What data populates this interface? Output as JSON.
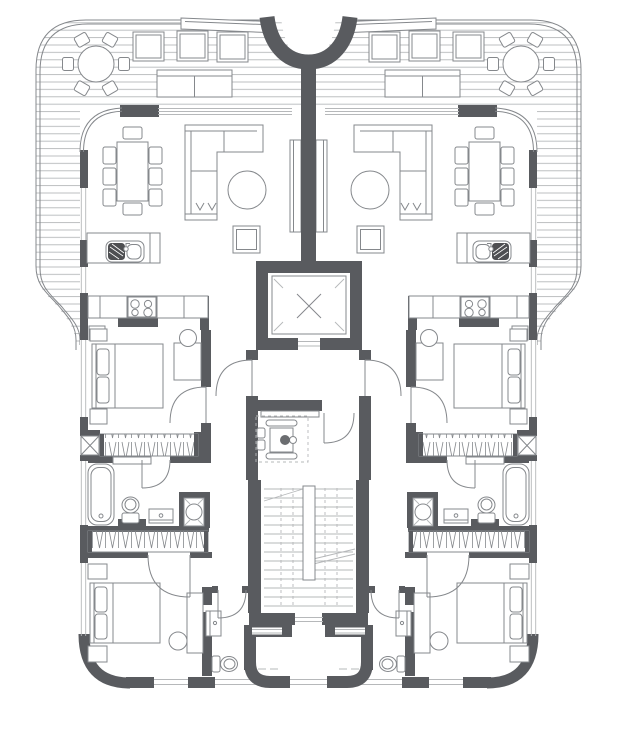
{
  "document": {
    "type": "architectural-floor-plan",
    "title": "Residential floor plan - two mirrored apartments around a central core",
    "visible_text": [],
    "symmetry": "mirror about vertical center axis"
  },
  "colors": {
    "background": "#ffffff",
    "wall": "#595b5f",
    "line": "#85888c",
    "light_line": "#b6b8ba",
    "sink_dark": "#4e4f52",
    "head_fill": "#6b6d70"
  },
  "core": {
    "elevator": {
      "symbol": "x-cross-cab",
      "corner_ticks": 4
    },
    "vestibule": {
      "symbol": "wheelchair-accessible",
      "bench": 1,
      "doors": 3
    },
    "staircase": {
      "treads": 14,
      "center_newel": 1,
      "dashed_guides": 4
    },
    "rear_exit": {
      "curved_wall_niches": 2,
      "windows": 2
    },
    "entry_funnel": {
      "shape": "U-curved wall at top center"
    }
  },
  "terrace_per_side": {
    "round_table_chairs": 6,
    "lounge_chairs": 3,
    "two_seat_sofa": 1,
    "planter": 1,
    "decking": "horizontal board lines"
  },
  "apartment_per_side": {
    "living_dining": [
      "dining-table",
      "8 dining chairs",
      "L-shaped sofa",
      "round coffee table",
      "pouf",
      "tv-cabinet"
    ],
    "kitchen": [
      "island with double sink and faucet",
      "counter with 4-burner cooktop",
      "counter return"
    ],
    "bedroom_1": [
      "double bed",
      "2 nightstands",
      "desk",
      "stool",
      "built-in wardrobe (hanger hatch)",
      "service shaft with X"
    ],
    "bathroom": [
      "bathtub",
      "toilet",
      "washbasin vanity",
      "shower with round head"
    ],
    "bedroom_2": [
      "double bed",
      "2 nightstands",
      "desk",
      "stool",
      "built-in wardrobe (hanger hatch)"
    ],
    "ensuite": [
      "washbasin vanity",
      "toilet"
    ],
    "windows": [
      "left facade 5 strips",
      "top glazing band",
      "bottom facade 2 strips"
    ]
  },
  "counts": {
    "apartments": 2,
    "bedrooms_total": 4,
    "bathrooms_total": 4,
    "door_swings_per_apartment": 5
  }
}
